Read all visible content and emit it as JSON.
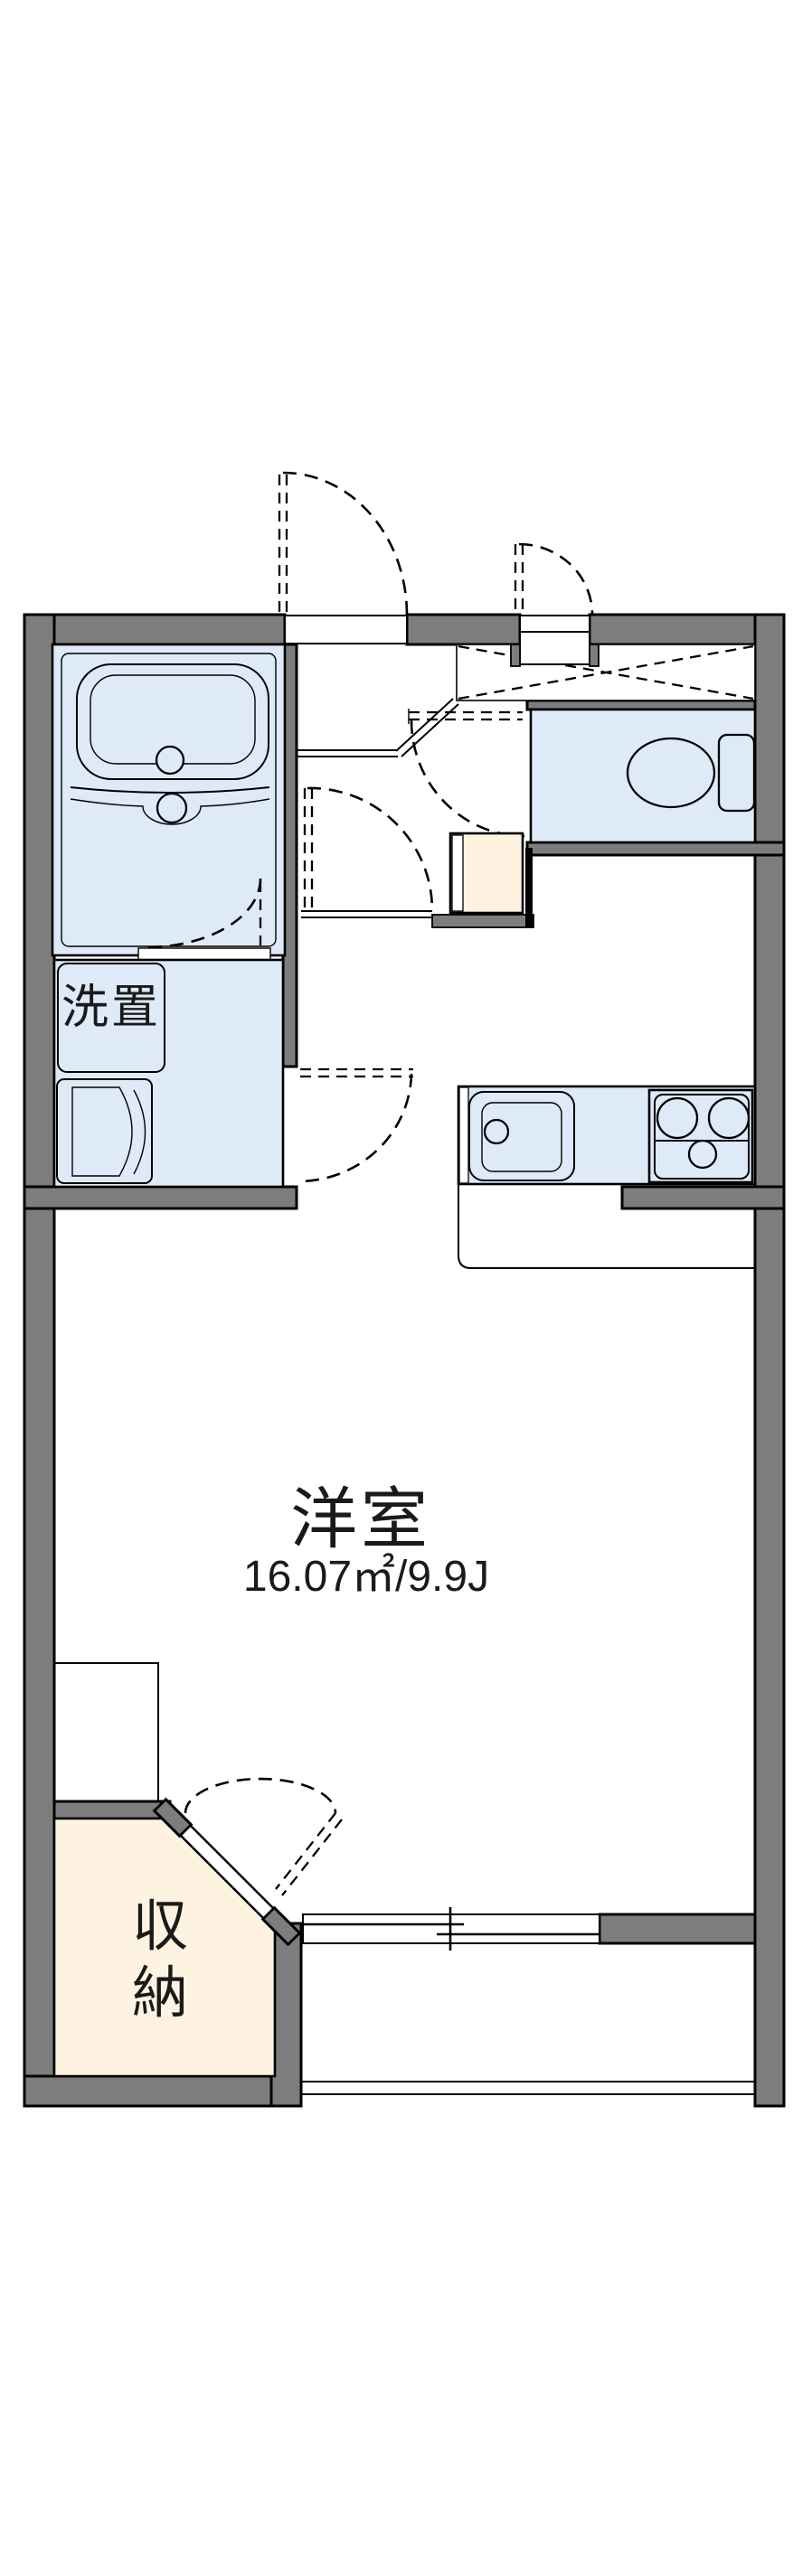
{
  "floorplan": {
    "type_label": "apartment-floorplan",
    "rooms": {
      "main_room": {
        "name_label": "洋室",
        "area_label": "16.07㎡/9.9J"
      },
      "washer_area": {
        "name_label": "洗置"
      },
      "closet": {
        "name_label": "収納",
        "name_label_line1": "収",
        "name_label_line2": "納"
      }
    },
    "colors": {
      "wall": "#7d7d7d",
      "fixture_blue": "#dfeaf8",
      "closet_cream": "#fdf3e0",
      "line": "#000000",
      "bg": "#ffffff"
    }
  }
}
